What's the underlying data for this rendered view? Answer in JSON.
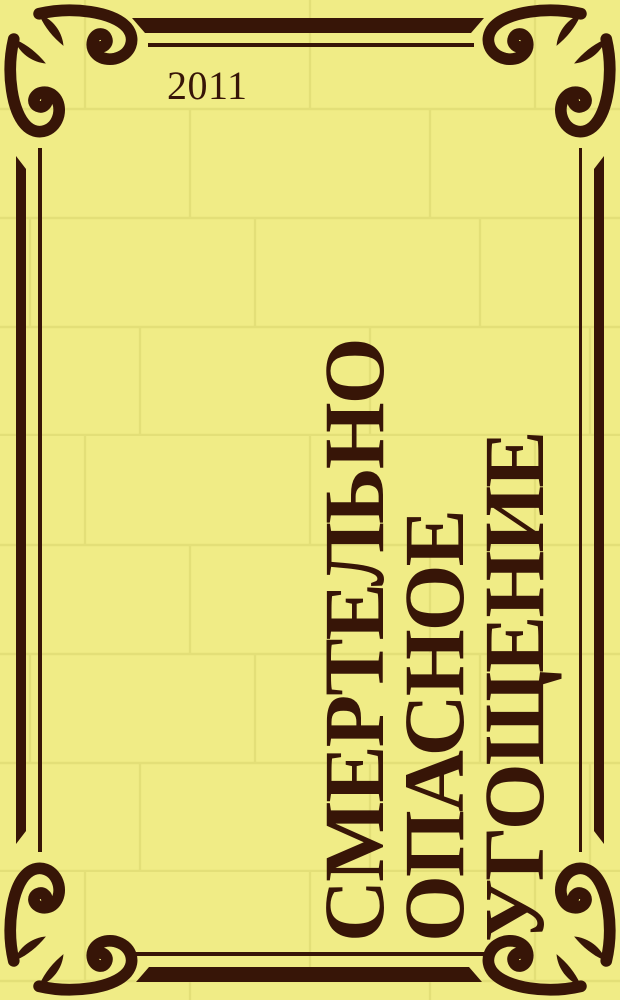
{
  "cover": {
    "year": "2011",
    "title_lines": [
      "СМЕРТЕЛЬНО",
      "ОПАСНОЕ",
      "УГОЩЕНИЕ"
    ],
    "title_full": "СМЕРТЕЛЬНО ОПАСНОЕ УГОЩЕНИЕ"
  },
  "colors": {
    "background": "#f0ec86",
    "tile_line": "#e3df78",
    "ink": "#371507"
  },
  "icons": {
    "corner_ornament": "baroque-corner-flourish"
  }
}
